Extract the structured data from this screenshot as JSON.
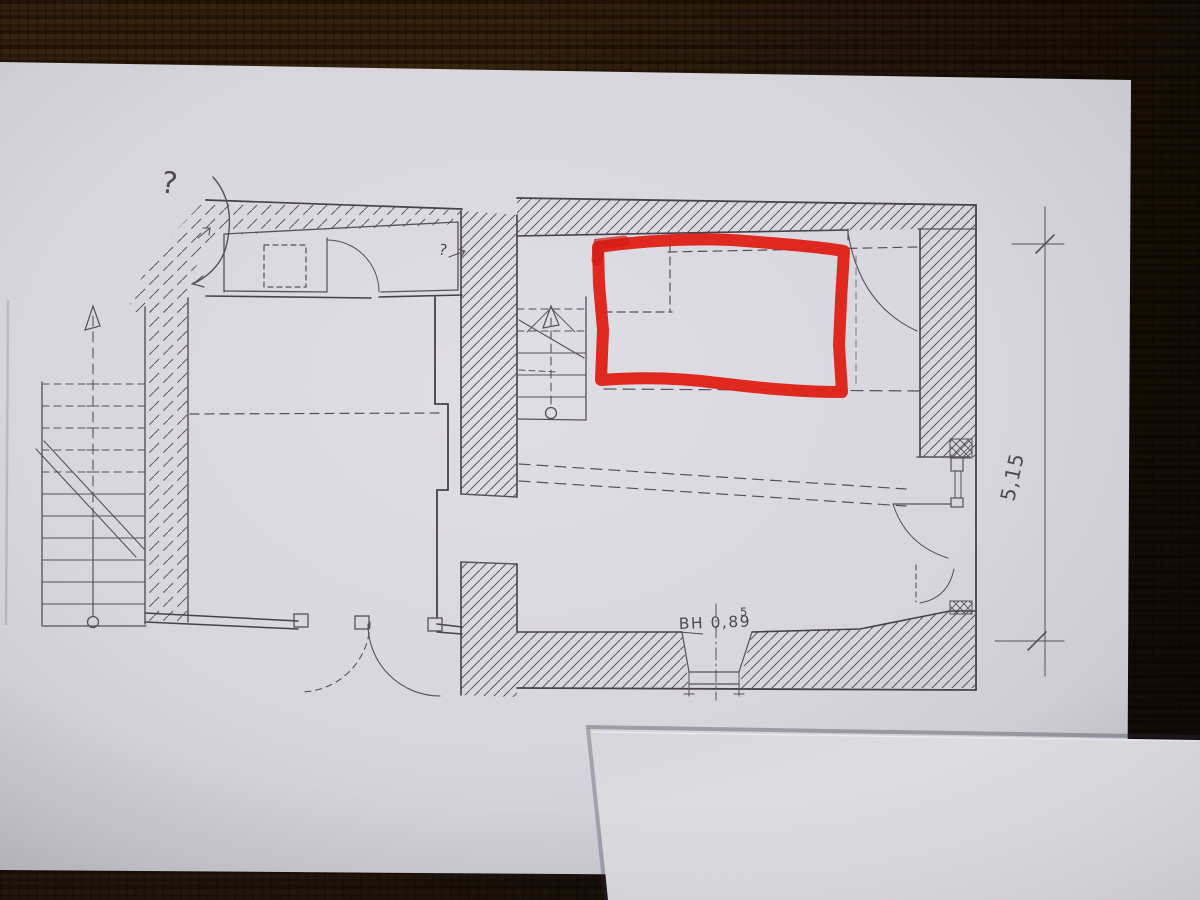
{
  "scene": {
    "description": "Photograph of a hand-drawn pencil floor plan on paper, lying on a dark wooden table, with a red marker rectangle highlighting one room"
  },
  "annotations": {
    "question_mark_large": "?",
    "question_mark_small": "?"
  },
  "labels": {
    "window_height_label": "BH 0,89",
    "window_height_superscript": "5",
    "right_dimension": "5,15"
  },
  "colors": {
    "red_marker": "#df2017",
    "pencil": "#56515d",
    "paper_main": "#d8d7dd",
    "paper_second_sheet": "#e4e3e7",
    "table_wood": "#2b1b0d"
  }
}
